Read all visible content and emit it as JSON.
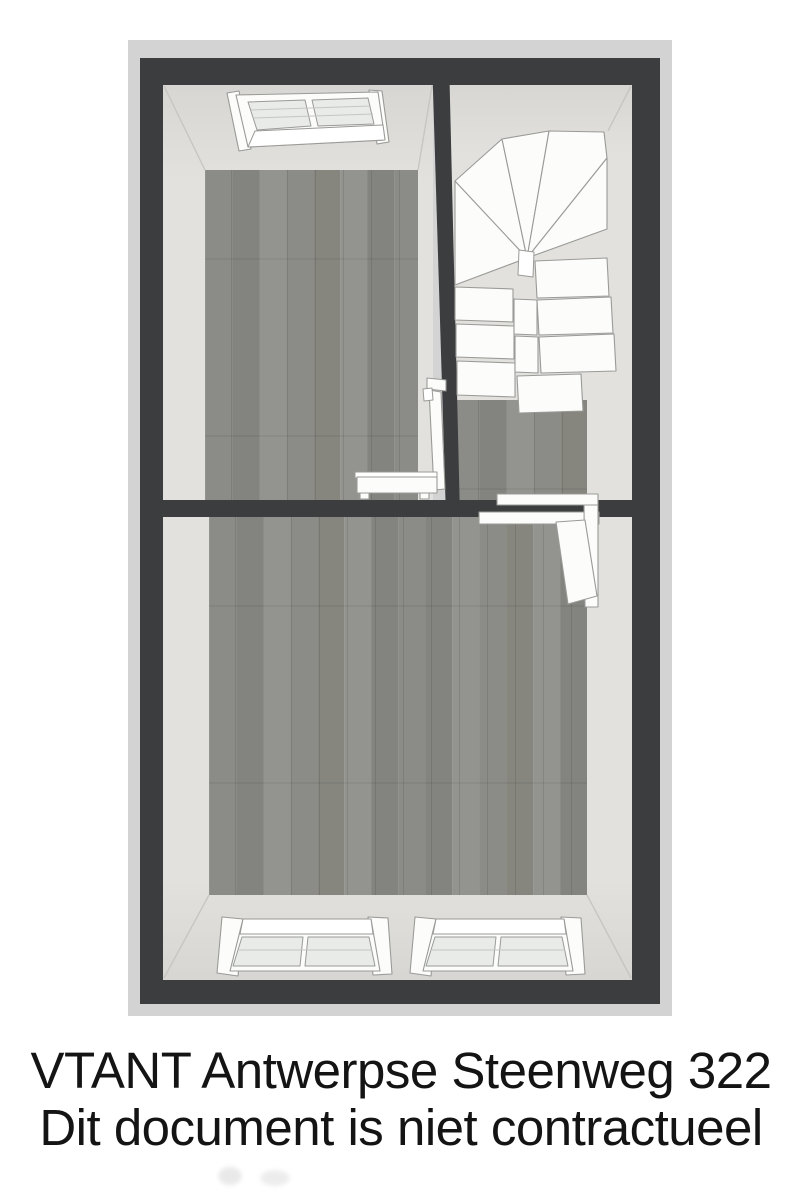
{
  "footer": {
    "line1": "VTANT Antwerpse Steenweg 322",
    "line2": "Dit document is niet contractueel"
  },
  "floorplan": {
    "type": "floor-plan-3d-top-view",
    "level": "attic",
    "rooms": [
      {
        "id": "room-top-left",
        "floor": "grey-wood-planks",
        "fixtures": [
          "skylight-window",
          "open-door",
          "radiator"
        ]
      },
      {
        "id": "stair-hall",
        "floor": "grey-wood-planks",
        "fixtures": [
          "winder-staircase",
          "open-door-with-frame"
        ]
      },
      {
        "id": "room-bottom",
        "floor": "grey-wood-planks",
        "fixtures": [
          "skylight-window-left",
          "skylight-window-right"
        ]
      }
    ]
  },
  "colors": {
    "background": "#ffffff",
    "panel": "#d3d3d3",
    "wall": "#3b3d3e",
    "surface": "#e2e1de",
    "surface_dark": "#d7d6d3",
    "floor": "#8b8b87",
    "floor_dark": "#83837f",
    "floor_light": "#93938f",
    "floor_dark2": "#86867f",
    "fixture": "#fcfcfb",
    "pane": "#e9ebe8",
    "stroke": "#9a9a97",
    "corner_line": "#c7c6c3",
    "text": "#141414"
  }
}
